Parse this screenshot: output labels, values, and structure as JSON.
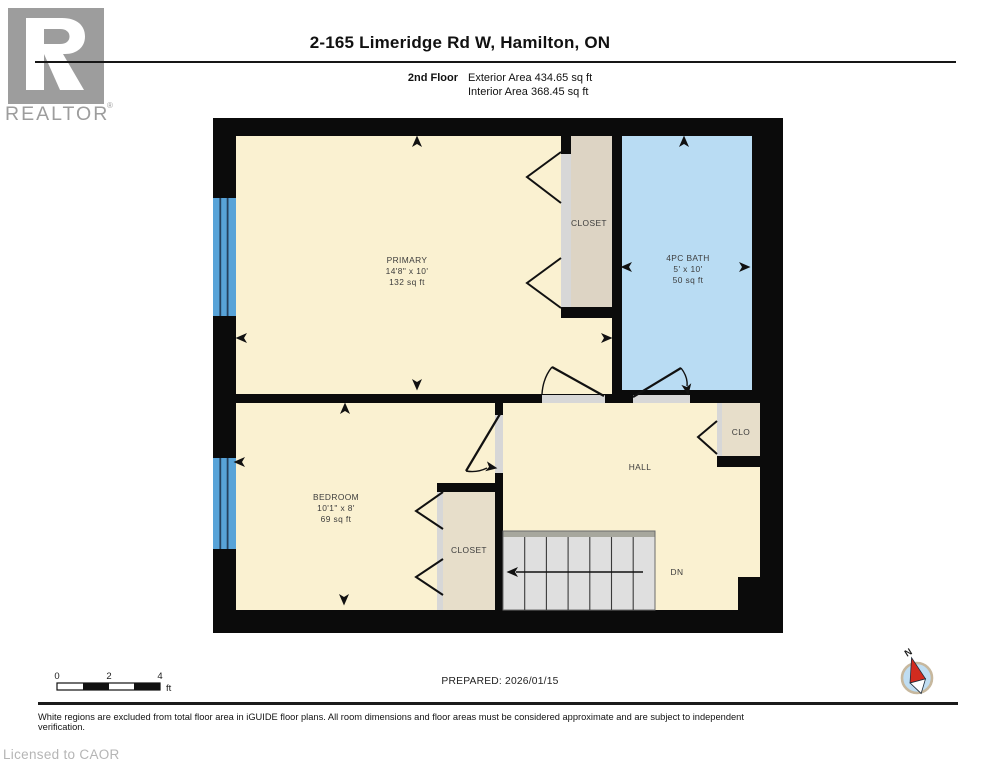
{
  "header": {
    "title": "2-165 Limeridge Rd W, Hamilton, ON",
    "floor_label": "2nd Floor",
    "exterior_area": "Exterior Area 434.65 sq ft",
    "interior_area": "Interior Area 368.45 sq ft"
  },
  "logo": {
    "brand": "REALTOR",
    "reg": "®"
  },
  "rooms": {
    "primary": {
      "name": "PRIMARY",
      "dims": "14'8\" x 10'",
      "area": "132 sq ft"
    },
    "primary_closet": {
      "name": "CLOSET"
    },
    "bath": {
      "name": "4PC BATH",
      "dims": "5' x 10'",
      "area": "50 sq ft"
    },
    "bedroom": {
      "name": "BEDROOM",
      "dims": "10'1\" x 8'",
      "area": "69 sq ft"
    },
    "bedroom_closet": {
      "name": "CLOSET"
    },
    "clo": {
      "name": "CLO"
    },
    "hall": {
      "name": "HALL"
    },
    "stairs": {
      "label": "DN"
    }
  },
  "compass": {
    "label": "N"
  },
  "scale_bar": {
    "ticks": [
      "0",
      "2",
      "4"
    ],
    "unit": "ft"
  },
  "footer": {
    "prepared": "PREPARED: 2026/01/15",
    "disclaimer": "White regions are excluded from total floor area in iGUIDE floor plans. All room dimensions and floor areas must be considered approximate and are subject to independent verification.",
    "license": "Licensed to CAOR"
  },
  "colors": {
    "wall": "#0b0b0b",
    "floor_cream": "#FAF1D1",
    "bath_blue": "#B9DCF3",
    "window_blue": "#58A3D8",
    "closet_taupe": "#DDD4C4",
    "closet_taupe_light": "#E7DECA",
    "door_strip": "#D7D7D7",
    "stair_gray": "#DFDFDF",
    "stair_bar": "#A7A79D",
    "compass_face": "#BFDDF2",
    "compass_ring": "#C7B89E",
    "compass_red": "#D22B1F",
    "logo_gray": "#9D9D9D"
  }
}
